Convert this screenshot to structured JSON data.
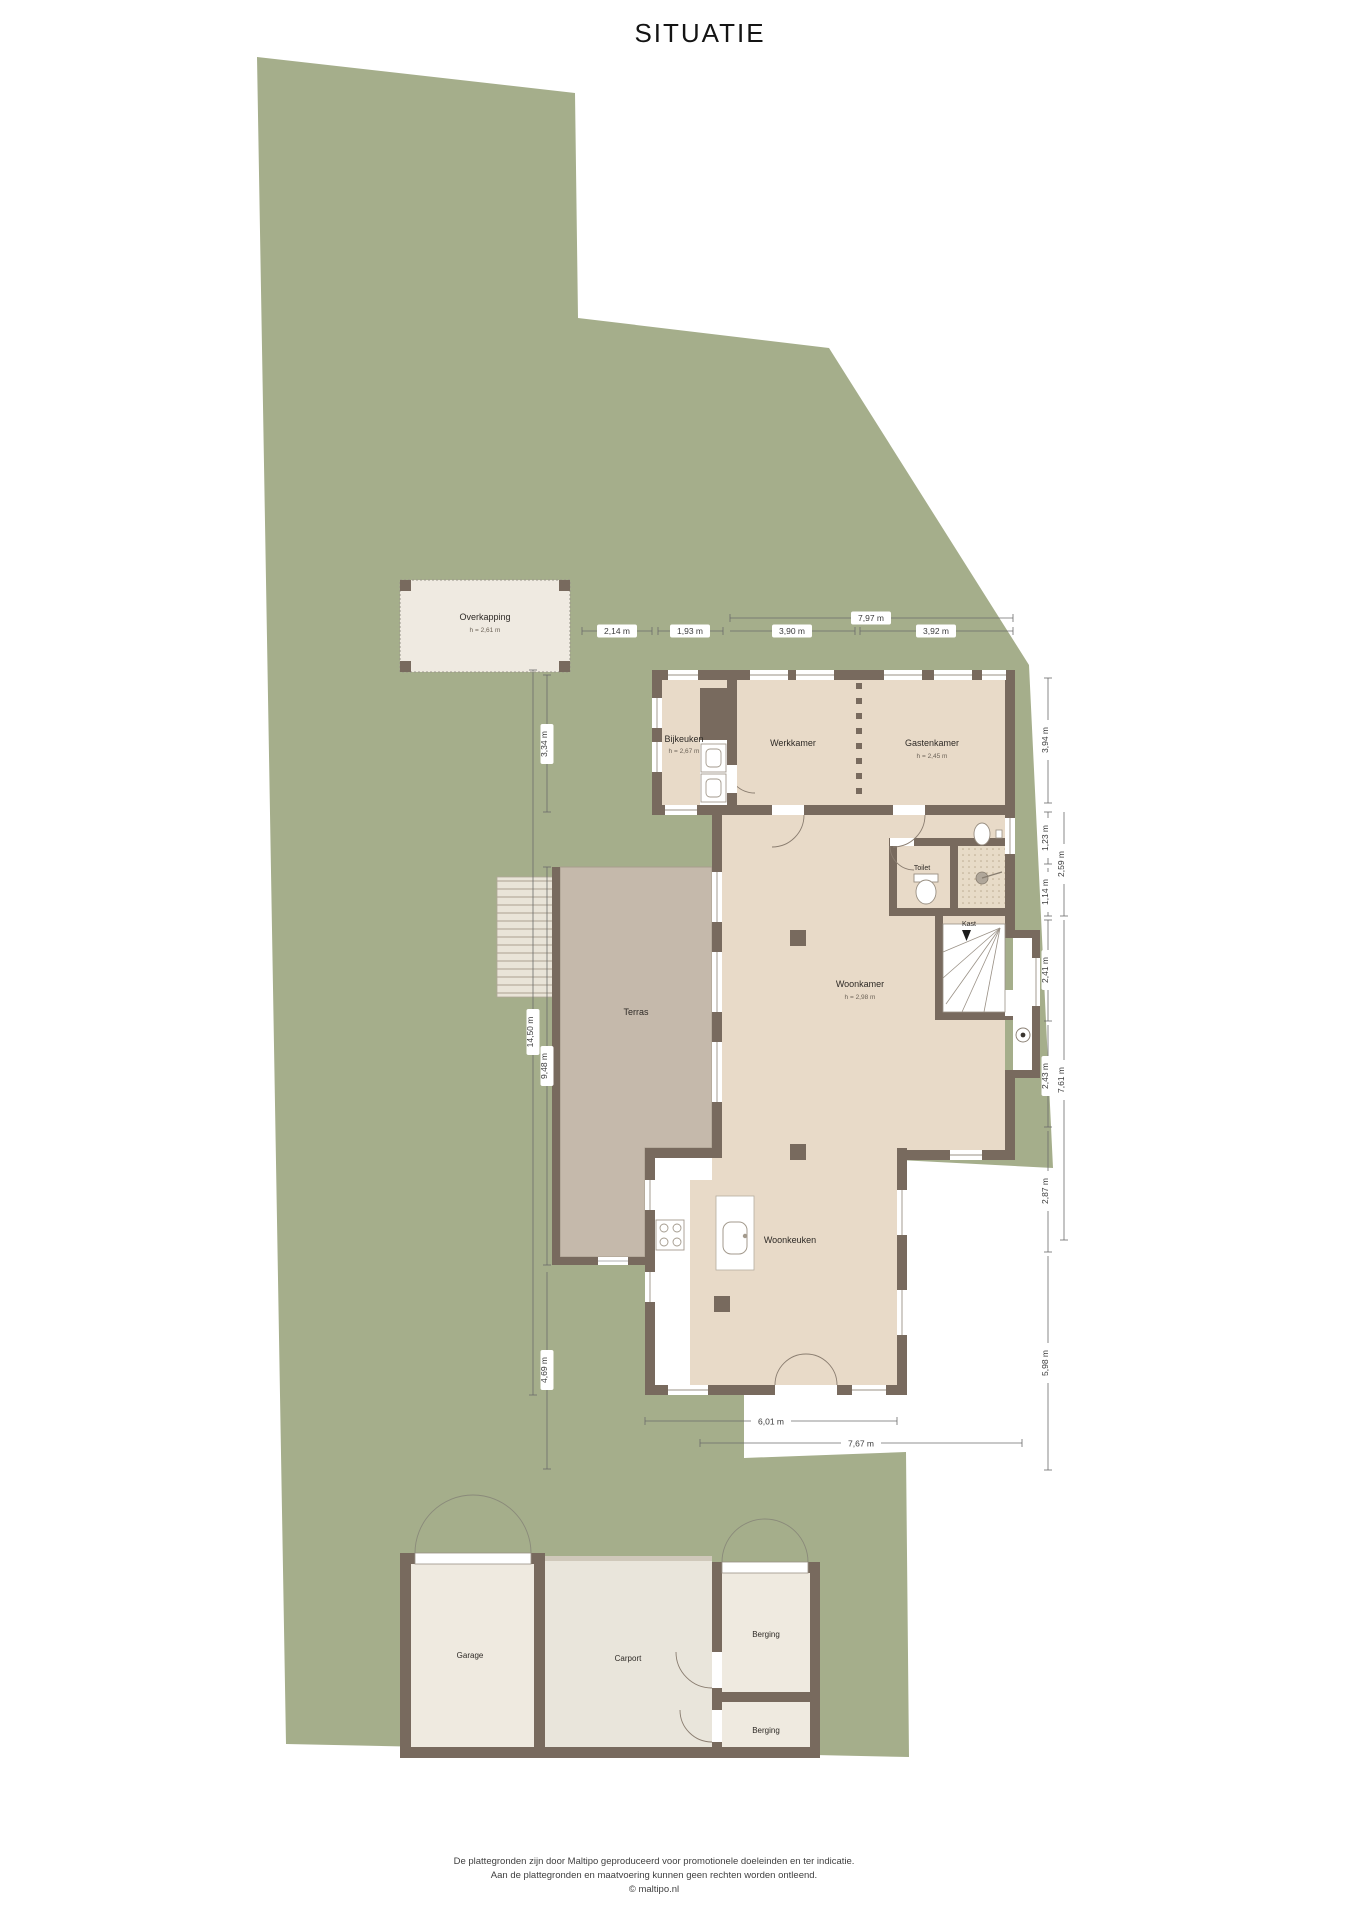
{
  "title": "SITUATIE",
  "plan": {
    "rooms": {
      "overkapping": {
        "label": "Overkapping",
        "sub": "h = 2,61 m"
      },
      "bijkeuken": {
        "label": "Bijkeuken",
        "sub": "h = 2,67 m"
      },
      "werkkamer": {
        "label": "Werkkamer"
      },
      "gastenkamer": {
        "label": "Gastenkamer",
        "sub": "h = 2,45 m"
      },
      "toilet": {
        "label": "Toilet"
      },
      "kast": {
        "label": "Kast"
      },
      "woonkamer": {
        "label": "Woonkamer",
        "sub": "h = 2,98 m"
      },
      "terras": {
        "label": "Terras"
      },
      "woonkeuken": {
        "label": "Woonkeuken"
      },
      "garage": {
        "label": "Garage"
      },
      "carport": {
        "label": "Carport"
      },
      "berging_1": {
        "label": "Berging"
      },
      "berging_2": {
        "label": "Berging"
      }
    },
    "dimensions": {
      "top": [
        "2,14 m",
        "1,93 m",
        "7,97 m",
        "3,90 m",
        "3,92 m"
      ],
      "right": [
        "3,94 m",
        "1,23 m",
        "2,59 m",
        "1,14 m",
        "2,41 m",
        "2,43 m",
        "7,61 m",
        "2,87 m",
        "5,98 m"
      ],
      "left": [
        "3,34 m",
        "9,48 m",
        "14,50 m",
        "4,69 m"
      ],
      "bottom": [
        "6,01 m",
        "7,67 m"
      ]
    },
    "colors": {
      "plot_green": "#a5ae8b",
      "wall_brown": "#786a5e",
      "room_beige": "#e8dac8",
      "terras_taupe": "#c5b9ab",
      "outbuilding_cream": "#efeae0",
      "carport_grey": "#e9e5db"
    }
  },
  "footer": {
    "line1": "De plattegronden zijn door Maltipo geproduceerd voor promotionele doeleinden en ter indicatie.",
    "line2": "Aan de plattegronden en maatvoering kunnen geen rechten worden ontleend.",
    "line3": "© maltipo.nl"
  }
}
